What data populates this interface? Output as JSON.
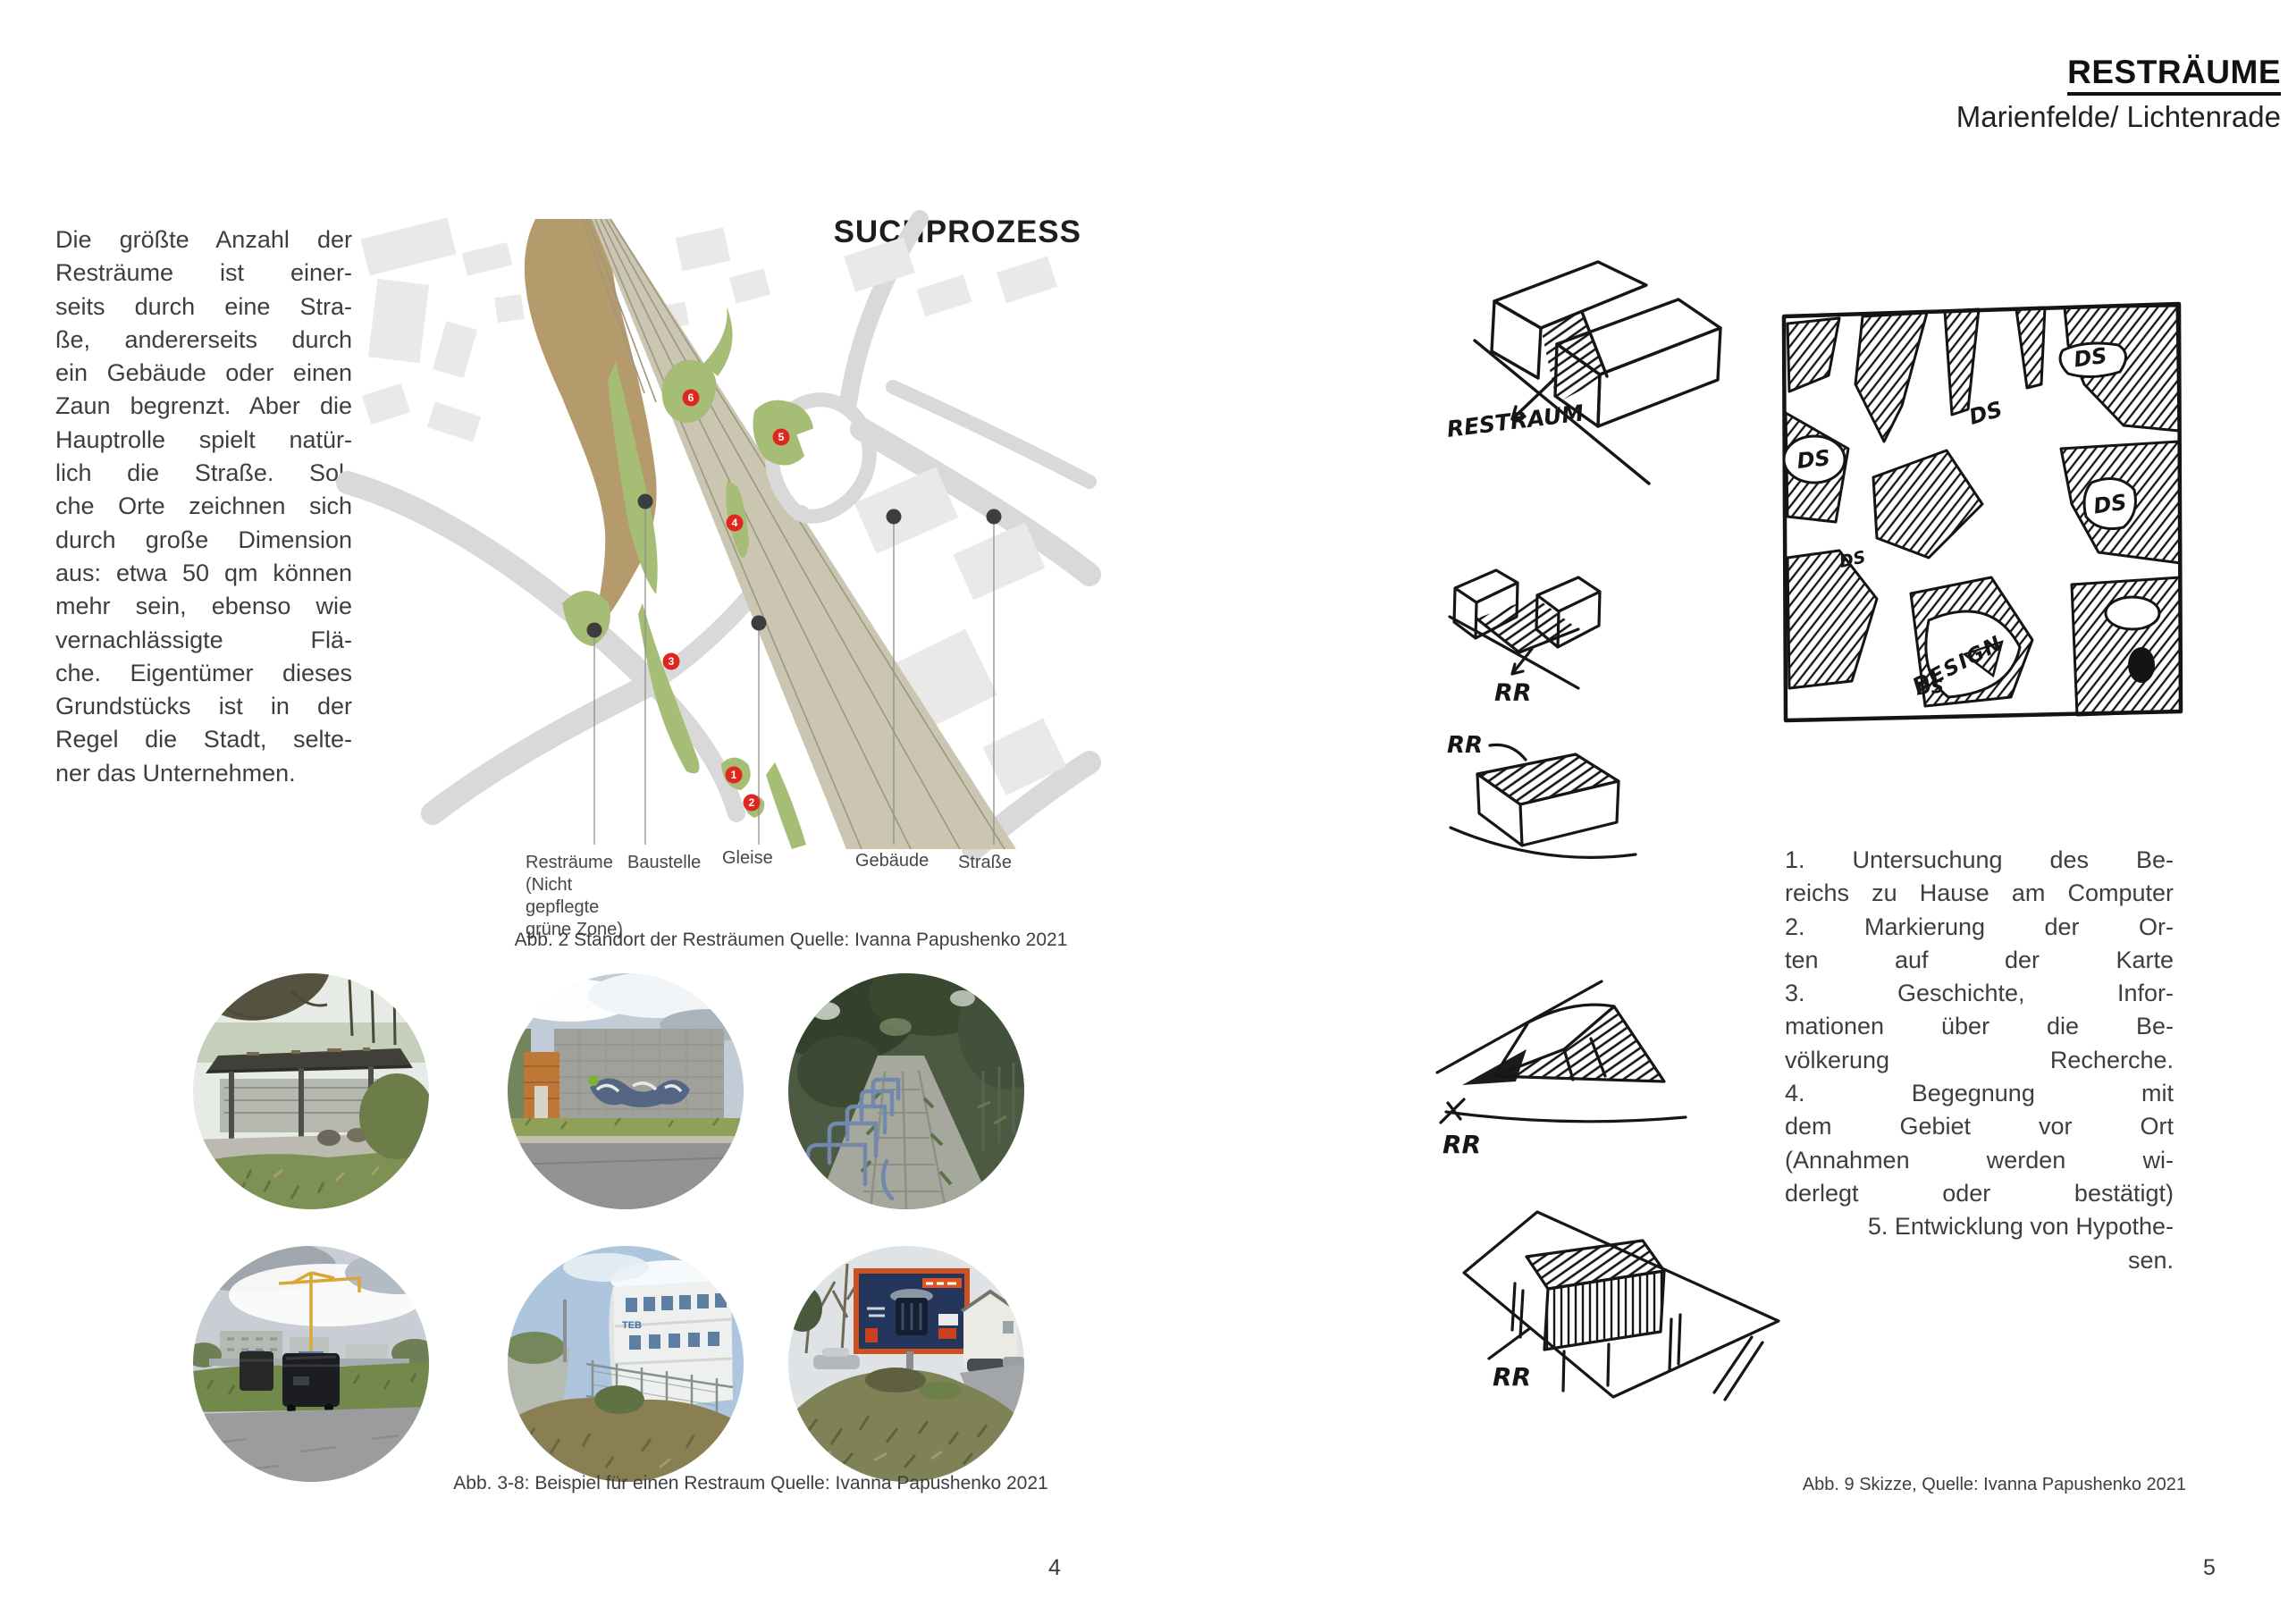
{
  "left_page": {
    "page_number": "4",
    "intro_lines": [
      {
        "t": "Die größte Anzahl der",
        "a": "j"
      },
      {
        "t": "Resträume ist einer-",
        "a": "j"
      },
      {
        "t": "seits durch eine Stra-",
        "a": "j"
      },
      {
        "t": "ße, andererseits durch",
        "a": "j"
      },
      {
        "t": "ein Gebäude oder einen",
        "a": "j"
      },
      {
        "t": "Zaun begrenzt. Aber die",
        "a": "j"
      },
      {
        "t": "Hauptrolle spielt natür-",
        "a": "j"
      },
      {
        "t": "lich die Straße. Sol-",
        "a": "j"
      },
      {
        "t": "che Orte zeichnen sich",
        "a": "j"
      },
      {
        "t": "durch große Dimension",
        "a": "j"
      },
      {
        "t": "aus: etwa 50 qm können",
        "a": "j"
      },
      {
        "t": "mehr sein, ebenso wie",
        "a": "j"
      },
      {
        "t": "vernachlässigte Flä-",
        "a": "j"
      },
      {
        "t": "che. Eigentümer dieses",
        "a": "j"
      },
      {
        "t": "Grundstücks ist in der",
        "a": "j"
      },
      {
        "t": "Regel die Stadt, selte-",
        "a": "j"
      },
      {
        "t": "ner das Unternehmen.",
        "a": "l"
      }
    ],
    "map": {
      "title": "SUCHPROZESS",
      "legend_labels": [
        "Resträume (Nicht gepflegte grüne Zone)",
        "Baustelle",
        "Gleise",
        "Gebäude",
        "Straße"
      ],
      "markers": [
        "1",
        "2",
        "3",
        "4",
        "5",
        "6"
      ],
      "colors": {
        "restraum_green": "#a6bd76",
        "baustelle_brown": "#b59a6c",
        "gleise_band": "#cac6b1",
        "gleise_line": "#9d977f",
        "strasse_gray": "#d9d9d9",
        "gebaeude_gray": "#e9e9e9",
        "marker_red": "#e0271f"
      }
    },
    "map_caption": "Abb. 2 Standort der Resträumen Quelle: Ivanna Papushenko 2021",
    "photos_caption": "Abb. 3-8: Beispiel für einen Restraum Quelle: Ivanna Papushenko 2021",
    "photos": [
      {
        "name": "carport-shelter"
      },
      {
        "name": "graffiti-wall"
      },
      {
        "name": "overgrown-bike-racks"
      },
      {
        "name": "dumpsters-construction-site"
      },
      {
        "name": "fenced-office-building",
        "visible_text": "TEB"
      },
      {
        "name": "billboard-on-hill",
        "visible_text": "BAUHAUS"
      }
    ]
  },
  "right_page": {
    "page_number": "5",
    "title": "RESTRÄUME",
    "subtitle": "Marienfelde/ Lichtenrade",
    "sketch_labels": {
      "restraum": "RESTRAUM",
      "rr": "RR",
      "ds": "DS",
      "design": "DESIGN"
    },
    "process_lines": [
      {
        "t": "1. Untersuchung des Be-",
        "a": "j"
      },
      {
        "t": "reichs zu Hause am Computer",
        "a": "j"
      },
      {
        "t": "2. Markierung der Or-",
        "a": "j"
      },
      {
        "t": "ten auf der Karte",
        "a": "j"
      },
      {
        "t": "3. Geschichte, Infor-",
        "a": "j"
      },
      {
        "t": "mationen über die Be-",
        "a": "j"
      },
      {
        "t": "völkerung Recherche.",
        "a": "j"
      },
      {
        "t": "4. Begegnung mit",
        "a": "j"
      },
      {
        "t": "dem Gebiet vor Ort",
        "a": "j"
      },
      {
        "t": "(Annahmen werden wi-",
        "a": "j"
      },
      {
        "t": "derlegt oder bestätigt)",
        "a": "j"
      },
      {
        "t": "5. Entwicklung von Hypothe-",
        "a": "r"
      },
      {
        "t": "sen.",
        "a": "r"
      }
    ],
    "sketch_caption": "Abb. 9 Skizze, Quelle: Ivanna Papushenko 2021"
  }
}
